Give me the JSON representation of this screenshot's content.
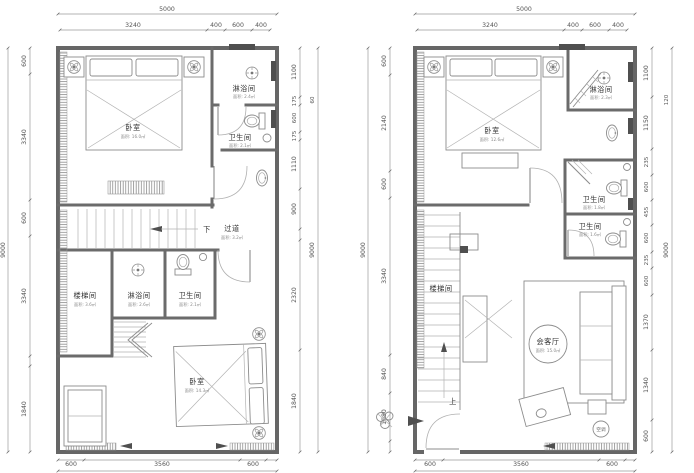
{
  "figure": {
    "type": "architectural-floor-plans",
    "panels": 2,
    "units": "mm"
  },
  "left_plan": {
    "dims": {
      "overall_width": "5000",
      "top": [
        "3240",
        "400",
        "600",
        "400"
      ],
      "overall_height_left": "9000",
      "left": [
        "600",
        "3340",
        "600",
        "3340",
        "1840"
      ],
      "right": [
        "1100",
        "175",
        "600",
        "175",
        "1110",
        "900",
        "2320",
        "1840"
      ],
      "right_outer_small": "60",
      "overall_height_right": "9000",
      "bottom": [
        "600",
        "3560",
        "600"
      ]
    },
    "rooms": {
      "bedroom_upper": {
        "label": "卧室",
        "area": "面积: 16.0㎡"
      },
      "shower_upper": {
        "label": "淋浴间",
        "area": "面积: 2.4㎡"
      },
      "toilet_upper": {
        "label": "卫生间",
        "area": "面积: 2.1㎡"
      },
      "down_label": "下",
      "corridor": {
        "label": "过道",
        "area": "面积: 3.2㎡"
      },
      "stairwell": {
        "label": "楼梯间",
        "area": "面积: 3.6㎡"
      },
      "shower_lower": {
        "label": "淋浴间",
        "area": "面积: 2.6㎡"
      },
      "toilet_lower": {
        "label": "卫生间",
        "area": "面积: 2.1㎡"
      },
      "bedroom_lower": {
        "label": "卧室",
        "area": "面积: 14.3㎡"
      }
    }
  },
  "right_plan": {
    "dims": {
      "overall_width": "5000",
      "top": [
        "3240",
        "400",
        "600",
        "400"
      ],
      "overall_height_left": "9000",
      "left": [
        "600",
        "2140",
        "600",
        "3340",
        "840",
        "1080"
      ],
      "right": [
        "1100",
        "1150",
        "235",
        "600",
        "455",
        "600",
        "235",
        "600",
        "1370",
        "1340",
        "600"
      ],
      "right_outer_small": "120",
      "overall_height_right": "9000",
      "bottom": [
        "600",
        "3560",
        "600"
      ]
    },
    "rooms": {
      "bedroom": {
        "label": "卧室",
        "area": "面积: 12.6㎡"
      },
      "shower": {
        "label": "淋浴间",
        "area": "面积: 2.3㎡"
      },
      "toilet_1": {
        "label": "卫生间",
        "area": "面积: 1.8㎡"
      },
      "toilet_2": {
        "label": "卫生间",
        "area": "面积: 1.6㎡"
      },
      "stairwell": {
        "label": "楼梯间"
      },
      "living": {
        "label": "会客厅",
        "area": "面积: 15.0㎡"
      },
      "up_label": "上",
      "ac_label": "空调"
    }
  }
}
